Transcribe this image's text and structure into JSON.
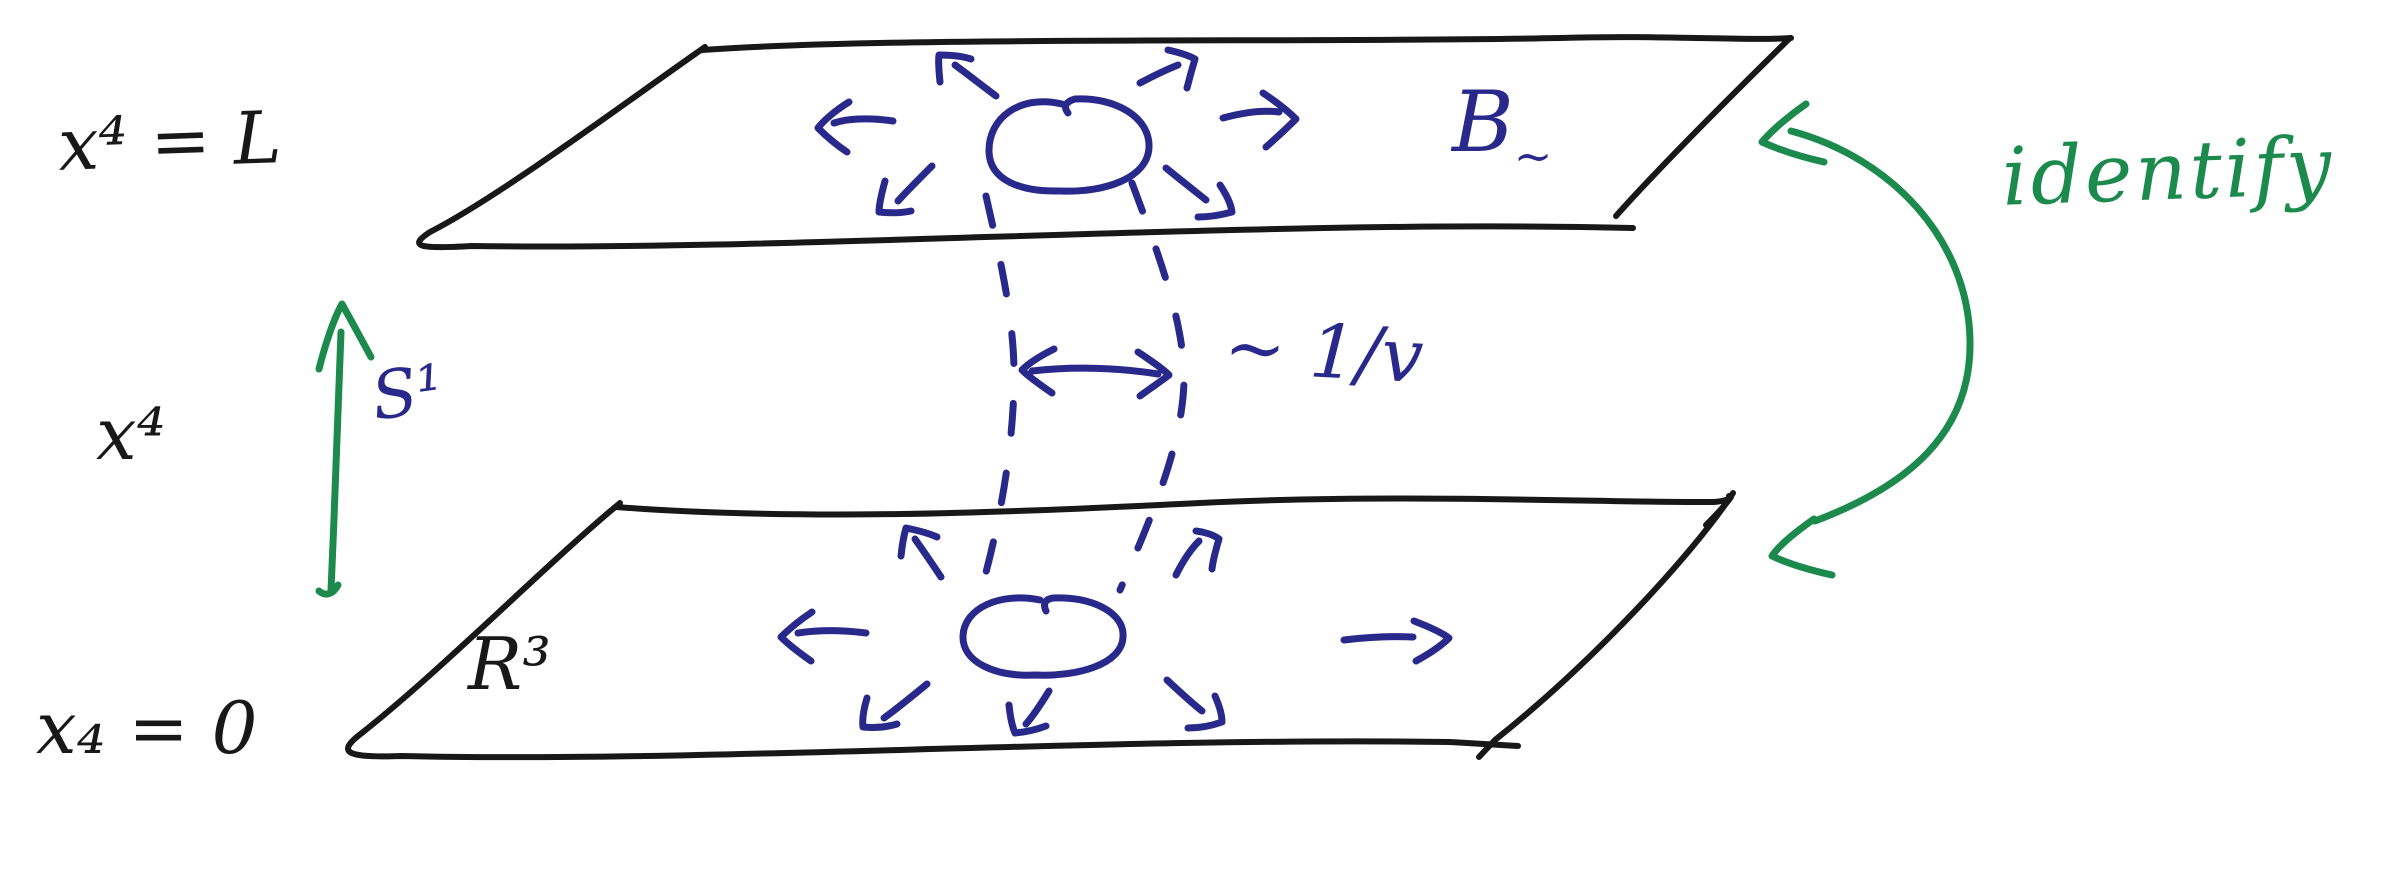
{
  "background": "#ffffff",
  "ink_colors": {
    "black": "#181818",
    "blue": "#29298c",
    "green": "#1b8a4c"
  },
  "labels": {
    "top_plane_coordinate": "x⁴ = L",
    "vertical_axis": "x⁴",
    "bottom_plane_coordinate": "x₄ = 0",
    "circle_fiber": "S¹",
    "space": "R³",
    "field": {
      "base": "B",
      "sub": "~"
    },
    "tube_width": "~ 1/v",
    "identification": "identify"
  }
}
